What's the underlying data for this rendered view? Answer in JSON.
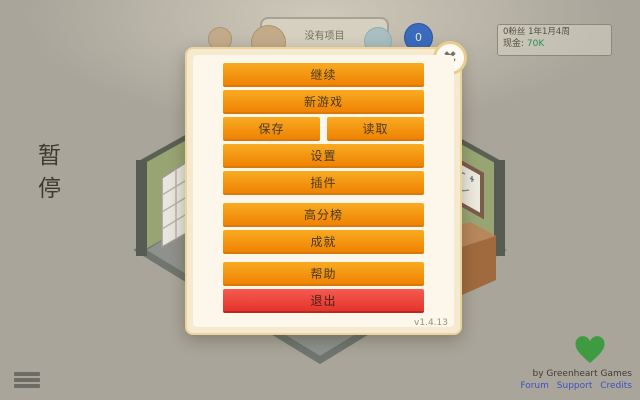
{
  "hud": {
    "speech_bubble": "没有项目",
    "research_count": "0",
    "stats": {
      "fans_date": "0粉丝 1年1月4周",
      "cash_label": "现金:",
      "cash_value": "70K"
    }
  },
  "pause": {
    "label": "暂停"
  },
  "menu": {
    "close_icon": "✖",
    "version": "v1.4.13",
    "buttons": [
      {
        "id": "continue",
        "label": "继续"
      },
      {
        "id": "new-game",
        "label": "新游戏"
      },
      {
        "id": "save",
        "label": "保存"
      },
      {
        "id": "load",
        "label": "读取"
      },
      {
        "id": "settings",
        "label": "设置"
      },
      {
        "id": "mods",
        "label": "插件"
      },
      {
        "id": "highscores",
        "label": "高分榜"
      },
      {
        "id": "achievements",
        "label": "成就"
      },
      {
        "id": "help",
        "label": "帮助"
      },
      {
        "id": "exit",
        "label": "退出"
      }
    ]
  },
  "footer": {
    "credit": "by Greenheart Games",
    "links": [
      {
        "label": "Forum"
      },
      {
        "label": "Support"
      },
      {
        "label": "Credits"
      }
    ]
  },
  "colors": {
    "button_orange_top": "#f9ab22",
    "button_orange_bottom": "#ef8303",
    "exit_red_top": "#f65a50",
    "exit_red_bottom": "#e3352c",
    "cash_green": "#2e8e5a",
    "heart_green": "#3f9b42",
    "link_blue": "#3c50c5",
    "dialog_cream": "#fcf7ea"
  }
}
